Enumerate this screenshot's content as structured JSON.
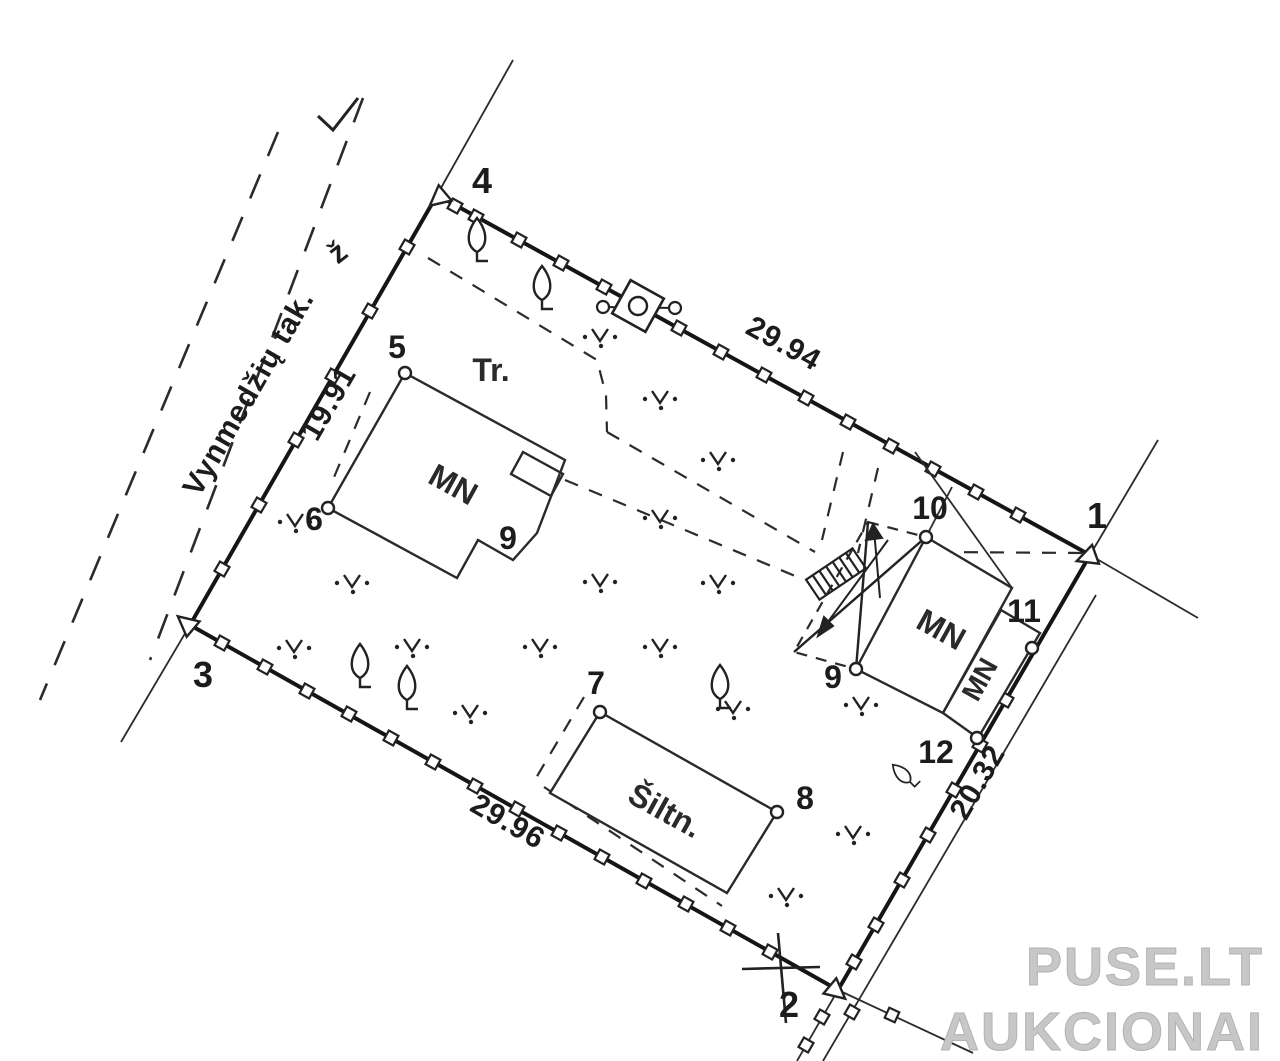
{
  "plan": {
    "street": {
      "name": "Vynmedžių tak.",
      "abbr": "ž"
    },
    "area_abbr": "Tr.",
    "dimensions": {
      "north": "29.94",
      "west": "19.91",
      "south": "29.96",
      "east": "20.32"
    },
    "boundary_points": {
      "p1": "1",
      "p2": "2",
      "p3": "3",
      "p4": "4"
    },
    "detail_points": {
      "p5": "5",
      "p6": "6",
      "p7": "7",
      "p8": "8",
      "p9_house": "9",
      "p9_outbuilding": "9",
      "p10": "10",
      "p11": "11",
      "p12": "12"
    },
    "buildings": {
      "house": "MN",
      "outbuilding": "MN",
      "annex": "MN",
      "greenhouse": "Šiltn."
    },
    "watermark": {
      "line1": "PUSE.LT",
      "line2": "AUKCIONAI"
    },
    "colors": {
      "ink": "#1c1c1c",
      "watermark": "#c7c7c7",
      "background": "#ffffff"
    }
  }
}
